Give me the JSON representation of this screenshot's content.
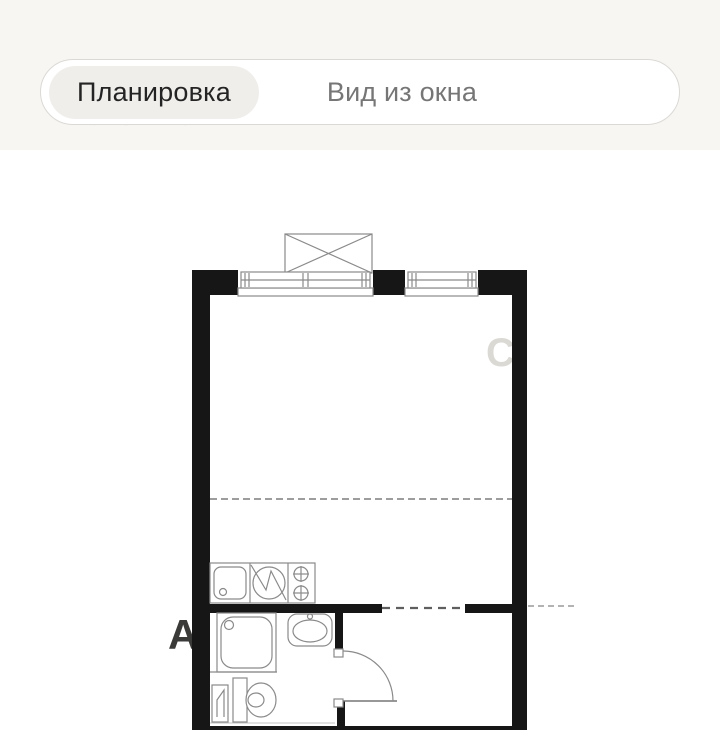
{
  "page": {
    "background_color": "#ffffff",
    "header_background_color": "#f7f6f3"
  },
  "tabs": {
    "items": [
      {
        "label": "Планировка",
        "selected": true
      },
      {
        "label": "Вид из окна",
        "selected": false
      }
    ],
    "selected_pill_color": "#f0eeeb",
    "selected_text_color": "#242424",
    "unselected_text_color": "#767676",
    "container_border_color": "#dbd9d5"
  },
  "watermark": {
    "top_fragment": "ЛОКАЛ",
    "middle_fragment": "С",
    "bottom_fragment": "А"
  },
  "floorplan": {
    "kind": "studio-apartment-floor-plan",
    "wall_color": "#161616",
    "line_color": "#8a8a8a",
    "features": [
      "window-double",
      "window-single",
      "ac-unit-box",
      "room-divider-dashed-line",
      "kitchen-counter",
      "kitchen-sink",
      "washing-machine",
      "cooktop-2-burner",
      "shower-tray",
      "washbasin",
      "toilet",
      "water-heater",
      "entrance-door-swing"
    ]
  }
}
